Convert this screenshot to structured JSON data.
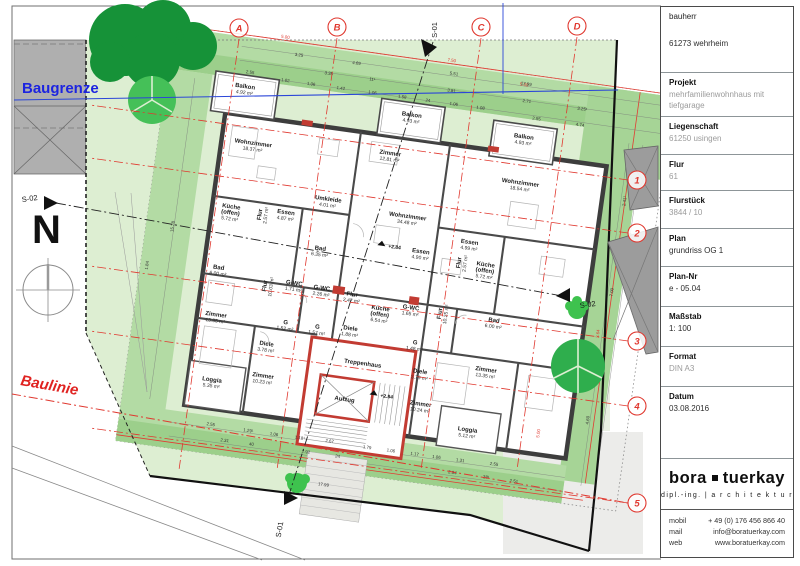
{
  "title_block": {
    "fields": [
      {
        "label": "bauherr",
        "plain": true,
        "value": "61273 wehrheim",
        "gray": false,
        "spacer": true
      },
      {
        "label": "Projekt",
        "value": "mehrfamilienwohnhaus mit tiefgarage",
        "gray": true
      },
      {
        "label": "Liegenschaft",
        "value": "61250 usingen",
        "gray": true
      },
      {
        "label": "Flur",
        "value": "61",
        "gray": true
      },
      {
        "label": "Flurstück",
        "value": "3844 / 10",
        "gray": true
      },
      {
        "label": "Plan",
        "value": "grundriss OG 1",
        "gray": false
      },
      {
        "label": "Plan-Nr",
        "value": "e - 05.04",
        "gray": false
      },
      {
        "label": "Maßstab",
        "value": "1: 100",
        "gray": false
      },
      {
        "label": "Format",
        "value": "DIN A3",
        "gray": true
      },
      {
        "label": "Datum",
        "value": "03.08.2016",
        "gray": false
      }
    ],
    "logo": {
      "name_left": "bora",
      "name_right": "tuerkay",
      "tagline": "dipl.-ing.  |  a r c h i t e k t u r"
    },
    "contact": [
      {
        "label": "mobil",
        "value": "+ 49 (0) 176 456 866 40"
      },
      {
        "label": "mail",
        "value": "info@boratuerkay.com"
      },
      {
        "label": "web",
        "value": "www.boratuerkay.com"
      }
    ]
  },
  "drawing": {
    "labels": {
      "baugrenze": "Baugrenze",
      "baulinie": "Baulinie",
      "north": "N",
      "s01": "S-01",
      "s02": "S-02",
      "treppenhaus": "Treppenhaus",
      "aufzug": "Aufzug"
    },
    "colors": {
      "grid_red": "#e0382f",
      "baugrenze_blue": "#1c24e0",
      "site_green": "#ddeed2",
      "hedge_green": "#b3dba4",
      "hedge_dark": "#9ccf8b",
      "tree_dark": "#169238",
      "tree_light": "#45c058",
      "wall_gray": "#3d3d3d",
      "accent_red": "#c23b32",
      "neighbor_gray": "#9c9c9c"
    },
    "grid_cols": [
      {
        "label": "A",
        "x": 239,
        "y": 28
      },
      {
        "label": "B",
        "x": 337,
        "y": 27
      },
      {
        "label": "C",
        "x": 481,
        "y": 27
      },
      {
        "label": "D",
        "x": 577,
        "y": 26
      }
    ],
    "grid_rows": [
      {
        "label": "1",
        "x": 637,
        "y": 180
      },
      {
        "label": "2",
        "x": 637,
        "y": 233
      },
      {
        "label": "3",
        "x": 637,
        "y": 341
      },
      {
        "label": "4",
        "x": 637,
        "y": 406
      },
      {
        "label": "5",
        "x": 637,
        "y": 503
      }
    ],
    "rooms": [
      {
        "lines": [
          "Wohnzimmer"
        ],
        "area": "18.37 m²",
        "x": 235,
        "y": 166
      },
      {
        "lines": [
          "Zimmer"
        ],
        "area": "12.81 m²",
        "x": 372,
        "y": 157
      },
      {
        "lines": [
          "Wohnzimmer"
        ],
        "area": "18.54 m²",
        "x": 505,
        "y": 168
      },
      {
        "lines": [
          "Wohnzimmer"
        ],
        "area": "34.48 m²",
        "x": 398,
        "y": 217
      },
      {
        "lines": [
          "Küche",
          "(offen)"
        ],
        "area": "5.72 m²",
        "x": 222,
        "y": 232
      },
      {
        "lines": [
          "Essen"
        ],
        "area": "4.87 m²",
        "x": 277,
        "y": 230
      },
      {
        "lines": [
          "Flur"
        ],
        "area": "2.57 m²",
        "x": 253,
        "y": 234,
        "rot": -90
      },
      {
        "lines": [
          "Umkleide"
        ],
        "area": "4.01 m²",
        "x": 317,
        "y": 211
      },
      {
        "lines": [
          "Bad"
        ],
        "area": "6.35 m²",
        "x": 316,
        "y": 261
      },
      {
        "lines": [
          "Essen"
        ],
        "area": "4.90 m²",
        "x": 416,
        "y": 250
      },
      {
        "lines": [
          "Essen"
        ],
        "area": "4.99 m²",
        "x": 463,
        "y": 234
      },
      {
        "lines": [
          "Flur"
        ],
        "area": "2.57 m²",
        "x": 457,
        "y": 254,
        "rot": -90
      },
      {
        "lines": [
          "Küche",
          "(offen)"
        ],
        "area": "5.72 m²",
        "x": 482,
        "y": 254
      },
      {
        "lines": [
          "Bad"
        ],
        "area": "6.00 m²",
        "x": 218,
        "y": 294
      },
      {
        "lines": [
          "Flur"
        ],
        "area": "10.03 m²",
        "x": 268,
        "y": 304,
        "rot": -90
      },
      {
        "lines": [
          "G-WC"
        ],
        "area": "1.71 m²",
        "x": 295,
        "y": 299
      },
      {
        "lines": [
          "G-WC"
        ],
        "area": "2.26 m²",
        "x": 323,
        "y": 300
      },
      {
        "lines": [
          "Flur"
        ],
        "area": "2.47 m²",
        "x": 354,
        "y": 302
      },
      {
        "lines": [
          "Küche",
          "(offen)"
        ],
        "area": "6.54 m²",
        "x": 384,
        "y": 312
      },
      {
        "lines": [
          "G-WC"
        ],
        "area": "1.65 m²",
        "x": 414,
        "y": 307
      },
      {
        "lines": [
          "Flur"
        ],
        "area": "10.25 m²",
        "x": 445,
        "y": 307,
        "rot": -90
      },
      {
        "lines": [
          "Bad"
        ],
        "area": "6.00 m²",
        "x": 498,
        "y": 308
      },
      {
        "lines": [
          "Zimmer"
        ],
        "area": "13.35 m²",
        "x": 222,
        "y": 341
      },
      {
        "lines": [
          "G"
        ],
        "area": "1.52 m²",
        "x": 292,
        "y": 339
      },
      {
        "lines": [
          "G"
        ],
        "area": "1.57 m²",
        "x": 324,
        "y": 339
      },
      {
        "lines": [
          "Diele"
        ],
        "area": "1.88 m²",
        "x": 357,
        "y": 336
      },
      {
        "lines": [
          "G"
        ],
        "area": "1.48 m²",
        "x": 423,
        "y": 341
      },
      {
        "lines": [
          "Diele"
        ],
        "area": "3.78 m²",
        "x": 276,
        "y": 363
      },
      {
        "lines": [
          "Diele"
        ],
        "area": "3.79 m²",
        "x": 432,
        "y": 369
      },
      {
        "lines": [
          "Zimmer"
        ],
        "area": "10.23 m²",
        "x": 277,
        "y": 395
      },
      {
        "lines": [
          "Zimmer"
        ],
        "area": "10.24 m²",
        "x": 437,
        "y": 401
      },
      {
        "lines": [
          "Zimmer"
        ],
        "area": "13.35 m²",
        "x": 497,
        "y": 358
      },
      {
        "lines": [
          "Loggia"
        ],
        "area": "5.35 m²",
        "x": 227,
        "y": 406
      },
      {
        "lines": [
          "Loggia"
        ],
        "area": "5.12 m²",
        "x": 487,
        "y": 420
      },
      {
        "lines": [
          "Balkon"
        ],
        "area": "4.92 m²",
        "x": 219,
        "y": 111
      },
      {
        "lines": [
          "Balkon"
        ],
        "area": "4.93 m²",
        "x": 388,
        "y": 116
      },
      {
        "lines": [
          "Balkon"
        ],
        "area": "4.93 m²",
        "x": 502,
        "y": 122
      }
    ],
    "levels": [
      {
        "t": "+2.84",
        "x": 383,
        "y": 249
      },
      {
        "t": "+2.84",
        "x": 396,
        "y": 398
      }
    ],
    "dims": [
      {
        "t": "5.00",
        "x": 252,
        "y": 56,
        "red": 1
      },
      {
        "t": "7.50",
        "x": 420,
        "y": 56,
        "red": 1
      },
      {
        "t": "5.00",
        "x": 495,
        "y": 70,
        "red": 1
      },
      {
        "t": "3.25",
        "x": 268,
        "y": 72
      },
      {
        "t": "4.69",
        "x": 326,
        "y": 72
      },
      {
        "t": "5.51",
        "x": 424,
        "y": 69
      },
      {
        "t": "17.99",
        "x": 497,
        "y": 69
      },
      {
        "t": "3.35",
        "x": 300,
        "y": 86
      },
      {
        "t": "11¹",
        "x": 344,
        "y": 86
      },
      {
        "t": "3.81",
        "x": 424,
        "y": 86
      },
      {
        "t": "2.71",
        "x": 500,
        "y": 86
      },
      {
        "t": "3.25¹",
        "x": 556,
        "y": 86
      },
      {
        "t": "2.55",
        "x": 222,
        "y": 96
      },
      {
        "t": "1.02",
        "x": 258,
        "y": 99
      },
      {
        "t": "1.06",
        "x": 284,
        "y": 99
      },
      {
        "t": "1.42",
        "x": 314,
        "y": 99
      },
      {
        "t": "1.06",
        "x": 346,
        "y": 99
      },
      {
        "t": "1.58",
        "x": 376,
        "y": 99
      },
      {
        "t": "24",
        "x": 402,
        "y": 99
      },
      {
        "t": "1.06",
        "x": 428,
        "y": 99
      },
      {
        "t": "1.08",
        "x": 455,
        "y": 99
      },
      {
        "t": "2.55",
        "x": 512,
        "y": 102
      },
      {
        "t": "4.74",
        "x": 556,
        "y": 102
      },
      {
        "t": "15.28",
        "x": 168,
        "y": 258,
        "rot": -90
      },
      {
        "t": "1.84",
        "x": 148,
        "y": 300,
        "rot": -90
      },
      {
        "t": "2.41¹",
        "x": 612,
        "y": 170,
        "rot": -90
      },
      {
        "t": "2.18",
        "x": 622,
        "y": 205,
        "rot": -90
      },
      {
        "t": "7.00",
        "x": 612,
        "y": 262,
        "rot": -90
      },
      {
        "t": "3.64",
        "x": 604,
        "y": 305,
        "rot": -90,
        "red": 1
      },
      {
        "t": "4.60",
        "x": 606,
        "y": 392,
        "rot": -90
      },
      {
        "t": "5.00",
        "x": 559,
        "y": 412,
        "rot": -90,
        "red": 1
      },
      {
        "t": "2.55",
        "x": 232,
        "y": 450
      },
      {
        "t": "1.29¹",
        "x": 270,
        "y": 451
      },
      {
        "t": "1.06",
        "x": 296,
        "y": 451
      },
      {
        "t": "1.18¹",
        "x": 322,
        "y": 451
      },
      {
        "t": "2.67",
        "x": 352,
        "y": 450
      },
      {
        "t": "1.79",
        "x": 390,
        "y": 451
      },
      {
        "t": "1.06",
        "x": 414,
        "y": 451
      },
      {
        "t": "1.17",
        "x": 438,
        "y": 451
      },
      {
        "t": "1.06",
        "x": 460,
        "y": 451
      },
      {
        "t": "1.31",
        "x": 484,
        "y": 451
      },
      {
        "t": "2.55",
        "x": 518,
        "y": 450
      },
      {
        "t": "2.31",
        "x": 248,
        "y": 464
      },
      {
        "t": "40",
        "x": 275,
        "y": 464
      },
      {
        "t": "2.92",
        "x": 330,
        "y": 464
      },
      {
        "t": "24",
        "x": 362,
        "y": 464
      },
      {
        "t": "2.94",
        "x": 478,
        "y": 464
      },
      {
        "t": "38¹",
        "x": 512,
        "y": 464
      },
      {
        "t": "2.51",
        "x": 540,
        "y": 464
      },
      {
        "t": "17.99",
        "x": 352,
        "y": 494
      }
    ]
  }
}
